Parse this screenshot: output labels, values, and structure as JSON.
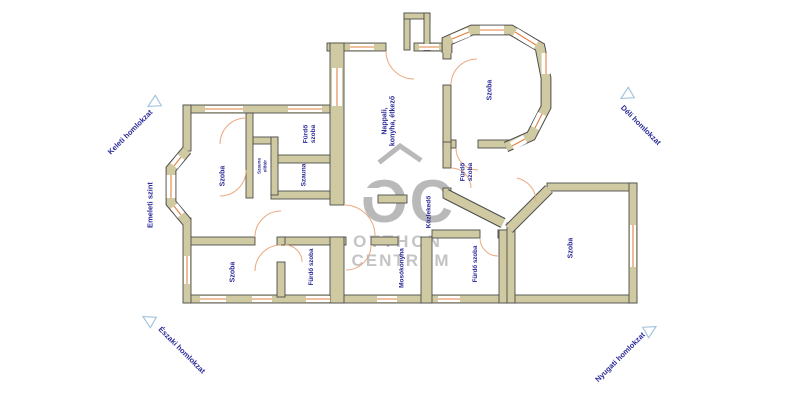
{
  "plan_title": "Alaprajz",
  "rooms": [
    {
      "id": "szoba-left",
      "lines": [
        "Szoba"
      ]
    },
    {
      "id": "furdo-szoba-1",
      "lines": [
        "Fürdő",
        "szoba"
      ]
    },
    {
      "id": "szauna-eloter",
      "lines": [
        "Szauna",
        "előtér"
      ]
    },
    {
      "id": "szauna",
      "lines": [
        "Szauna"
      ]
    },
    {
      "id": "nappali",
      "lines": [
        "Nappali,",
        "konyha, étkező"
      ]
    },
    {
      "id": "szoba-bay",
      "lines": [
        "Szoba"
      ]
    },
    {
      "id": "furdo-szoba-2",
      "lines": [
        "Fürdő",
        "szoba"
      ]
    },
    {
      "id": "kozlekedo",
      "lines": [
        "Közlekedő"
      ]
    },
    {
      "id": "szoba-right",
      "lines": [
        "Szoba"
      ]
    },
    {
      "id": "szoba-bottom",
      "lines": [
        "Szoba"
      ]
    },
    {
      "id": "furdo-szoba-3",
      "lines": [
        "Fürdő szoba"
      ]
    },
    {
      "id": "mosokonyha",
      "lines": [
        "Mosókonyha"
      ]
    },
    {
      "id": "furdo-szoba-4",
      "lines": [
        "Fürdő szoba"
      ]
    }
  ],
  "facades": [
    {
      "id": "keleti",
      "label": "Keleti homlokzat"
    },
    {
      "id": "deli",
      "label": "Déli homlokzat"
    },
    {
      "id": "emeleti",
      "label": "Emeleti szint"
    },
    {
      "id": "eszaki",
      "label": "Északi homlokzat"
    },
    {
      "id": "nyugati",
      "label": "Nyugati homlokzat"
    }
  ],
  "watermark": {
    "logo": "OC",
    "line1": "OTTHON",
    "line2": "CENTRUM"
  },
  "colors": {
    "wall": "#d0caa2",
    "edge": "#4d4d4d",
    "window": "#e2813f",
    "door": "#eaa87f",
    "label": "#2a2a99",
    "marker": "#a6c6de",
    "watermark": "#b9b9b9",
    "watermark_text": "#c4c4c4"
  }
}
